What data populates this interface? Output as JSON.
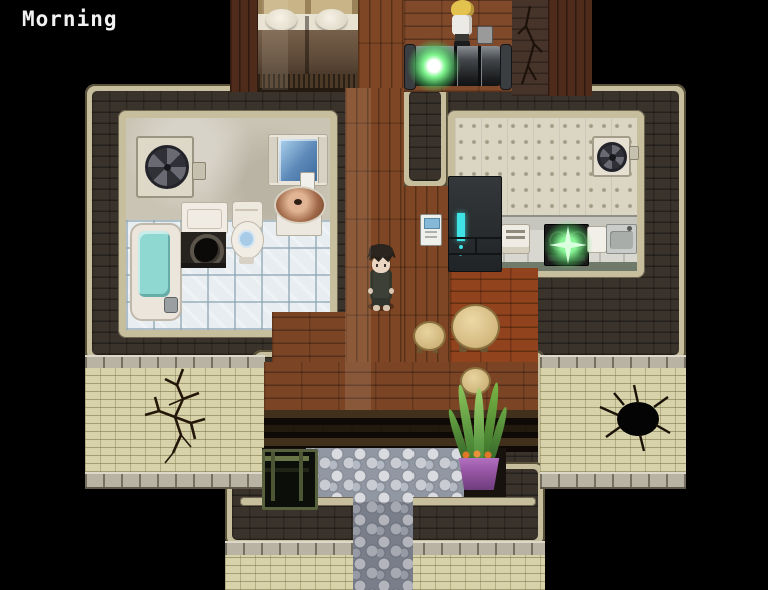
{
  "hud": {
    "time_label": "Morning"
  },
  "palette": {
    "background": "#000000",
    "wall_brick_dark": "#3a332b",
    "trim_beige": "#c7be9e",
    "brick_cream": "#d7d2a9",
    "wood_floor": "#7b4425",
    "wood_floor_red": "#91431d",
    "tile_floor": "#e7edf0",
    "plaster_wall": "#cac4b5",
    "wallpaper": "#dbd5c3",
    "cobblestone": "#9298a3",
    "water_teal": "#8fd8d2",
    "accent_green_glow": "#7ef58c",
    "accent_cyan": "#3fe3e6",
    "pot_purple": "#9b59a8"
  },
  "scene": {
    "style": "top-down RPG interior map",
    "rooms": [
      {
        "id": "bedroom",
        "name": "bedroom with two beds (top)"
      },
      {
        "id": "bathroom",
        "name": "bathroom with bathtub, washing machine, toilet, sink, mirror, fan"
      },
      {
        "id": "kitchen",
        "name": "kitchen with refrigerator, counter, stove, sink, fan"
      },
      {
        "id": "hallway",
        "name": "wooden hallway"
      },
      {
        "id": "entry",
        "name": "entryway with steps and cobblestone path"
      }
    ],
    "characters": [
      {
        "id": "player",
        "name": "dark-haired character in dark clothes",
        "location": "hallway"
      },
      {
        "id": "npc",
        "name": "blonde character in white top",
        "location": "top room"
      }
    ],
    "objects": [
      {
        "id": "glowing-machine",
        "name": "metal cylinder machine with green glow"
      },
      {
        "id": "stove-sparkle",
        "name": "green sparkle effect on stove"
      },
      {
        "id": "potted-plant",
        "name": "snake plant in purple pot"
      },
      {
        "id": "crate",
        "name": "dark green crate"
      },
      {
        "id": "dining-table",
        "name": "round wooden table"
      },
      {
        "id": "stool",
        "name": "wooden stool",
        "count": 2
      },
      {
        "id": "wall-crack",
        "name": "cracks and hole in exterior walls",
        "count": 3
      }
    ]
  }
}
